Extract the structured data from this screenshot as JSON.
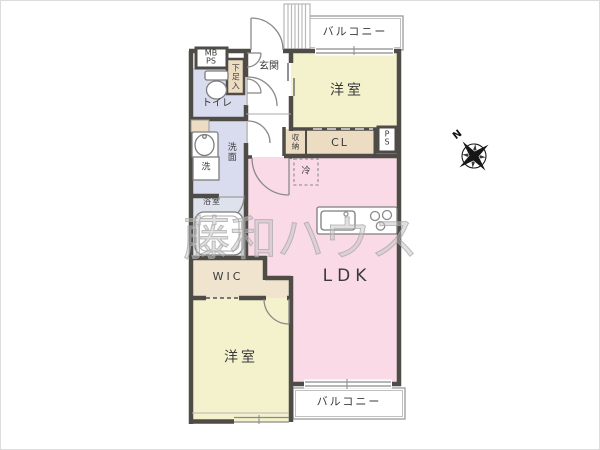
{
  "palette": {
    "wall": "#4f4b47",
    "line": "#8a8a8a",
    "thin": "#9a9a9a",
    "room_yellow": "#f3f2cd",
    "room_pink": "#f9dae6",
    "room_blue": "#d9dcee",
    "room_bath": "#dde2ec",
    "closet_beige": "#ecdcc2",
    "wic_beige": "#f0e4cf",
    "white": "#ffffff",
    "compass": "#161616"
  },
  "labels": {
    "balcony_top": "バルコニー",
    "balcony_bottom": "バルコニー",
    "room_top": "洋室",
    "room_bottom": "洋室",
    "ldk": "LDK",
    "wic": "WIC",
    "cl": "CL",
    "genkan": "玄関",
    "shoe_box": "下足入",
    "toilet": "トイレ",
    "washroom": "洗面",
    "laundry": "洗",
    "bathroom": "浴室",
    "storage": "収納",
    "fridge": "冷",
    "mb_ps_line1": "MB",
    "mb_ps_line2": "PS",
    "ps_line1": "P",
    "ps_line2": "S",
    "compass_north": "N",
    "watermark": "藤和ハウス"
  }
}
